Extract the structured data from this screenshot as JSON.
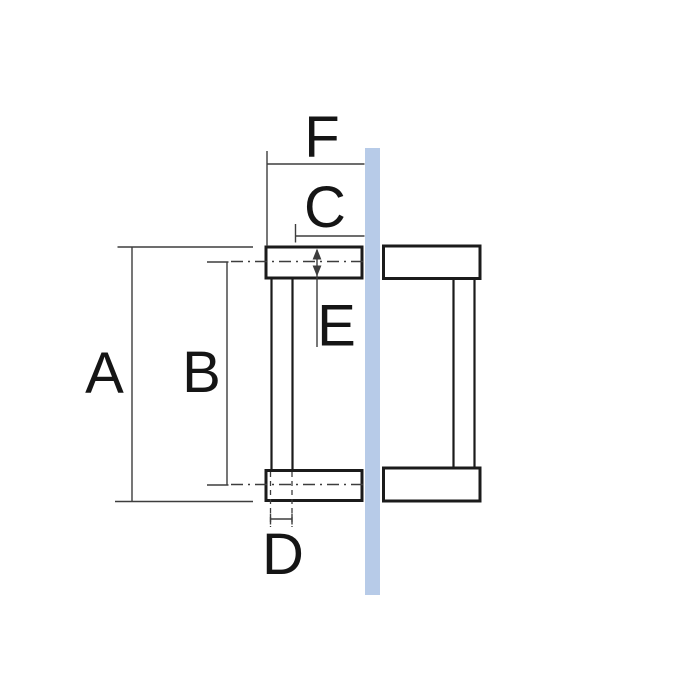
{
  "diagram": {
    "labels": {
      "a": "A",
      "b": "B",
      "c": "C",
      "d": "D",
      "e": "E",
      "f": "F"
    },
    "colors": {
      "background": "#ffffff",
      "glass_panel": "#b7cbe8",
      "handle_outline": "#1b1b1b",
      "dimension_line": "#3d3d3d",
      "label_text": "#151515"
    }
  }
}
